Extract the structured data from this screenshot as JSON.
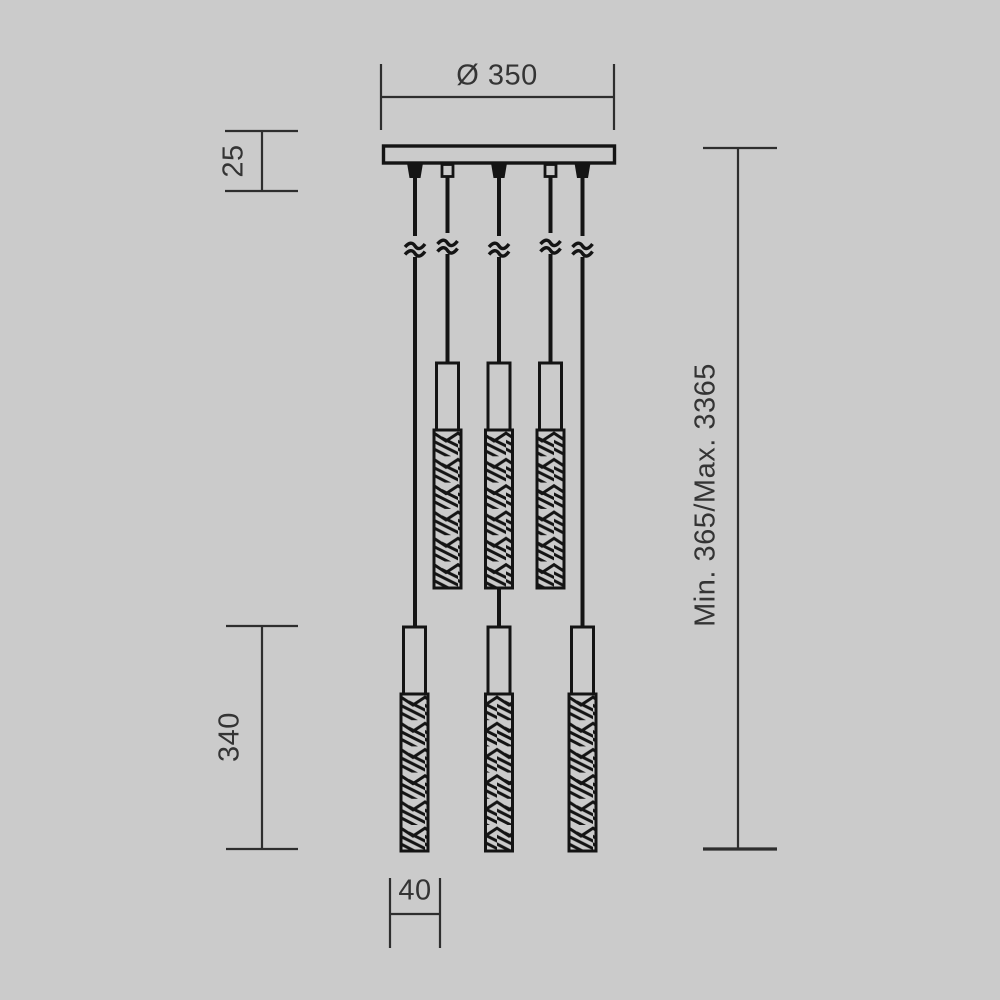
{
  "page": {
    "type": "technical-dimension-drawing",
    "subject": "pendant-chandelier-line-drawing"
  },
  "colors": {
    "background": "#cbcbcb",
    "drawing_line": "#141414",
    "dimension_line": "#2e2e2e",
    "text": "#343434"
  },
  "dimensions": {
    "canopy_diameter": {
      "label": "Ø 350",
      "orientation": "horizontal"
    },
    "canopy_height": {
      "label": "25",
      "orientation": "vertical"
    },
    "pendant_length": {
      "label": "340",
      "orientation": "vertical"
    },
    "suspension_height": {
      "label": "Min. 365/Max. 3365",
      "orientation": "vertical"
    },
    "pendant_width": {
      "label": "40",
      "orientation": "horizontal"
    }
  },
  "structure": {
    "cables": 5,
    "cable_break_marks": 5,
    "upper_pendants": 3,
    "lower_pendants": 3
  }
}
